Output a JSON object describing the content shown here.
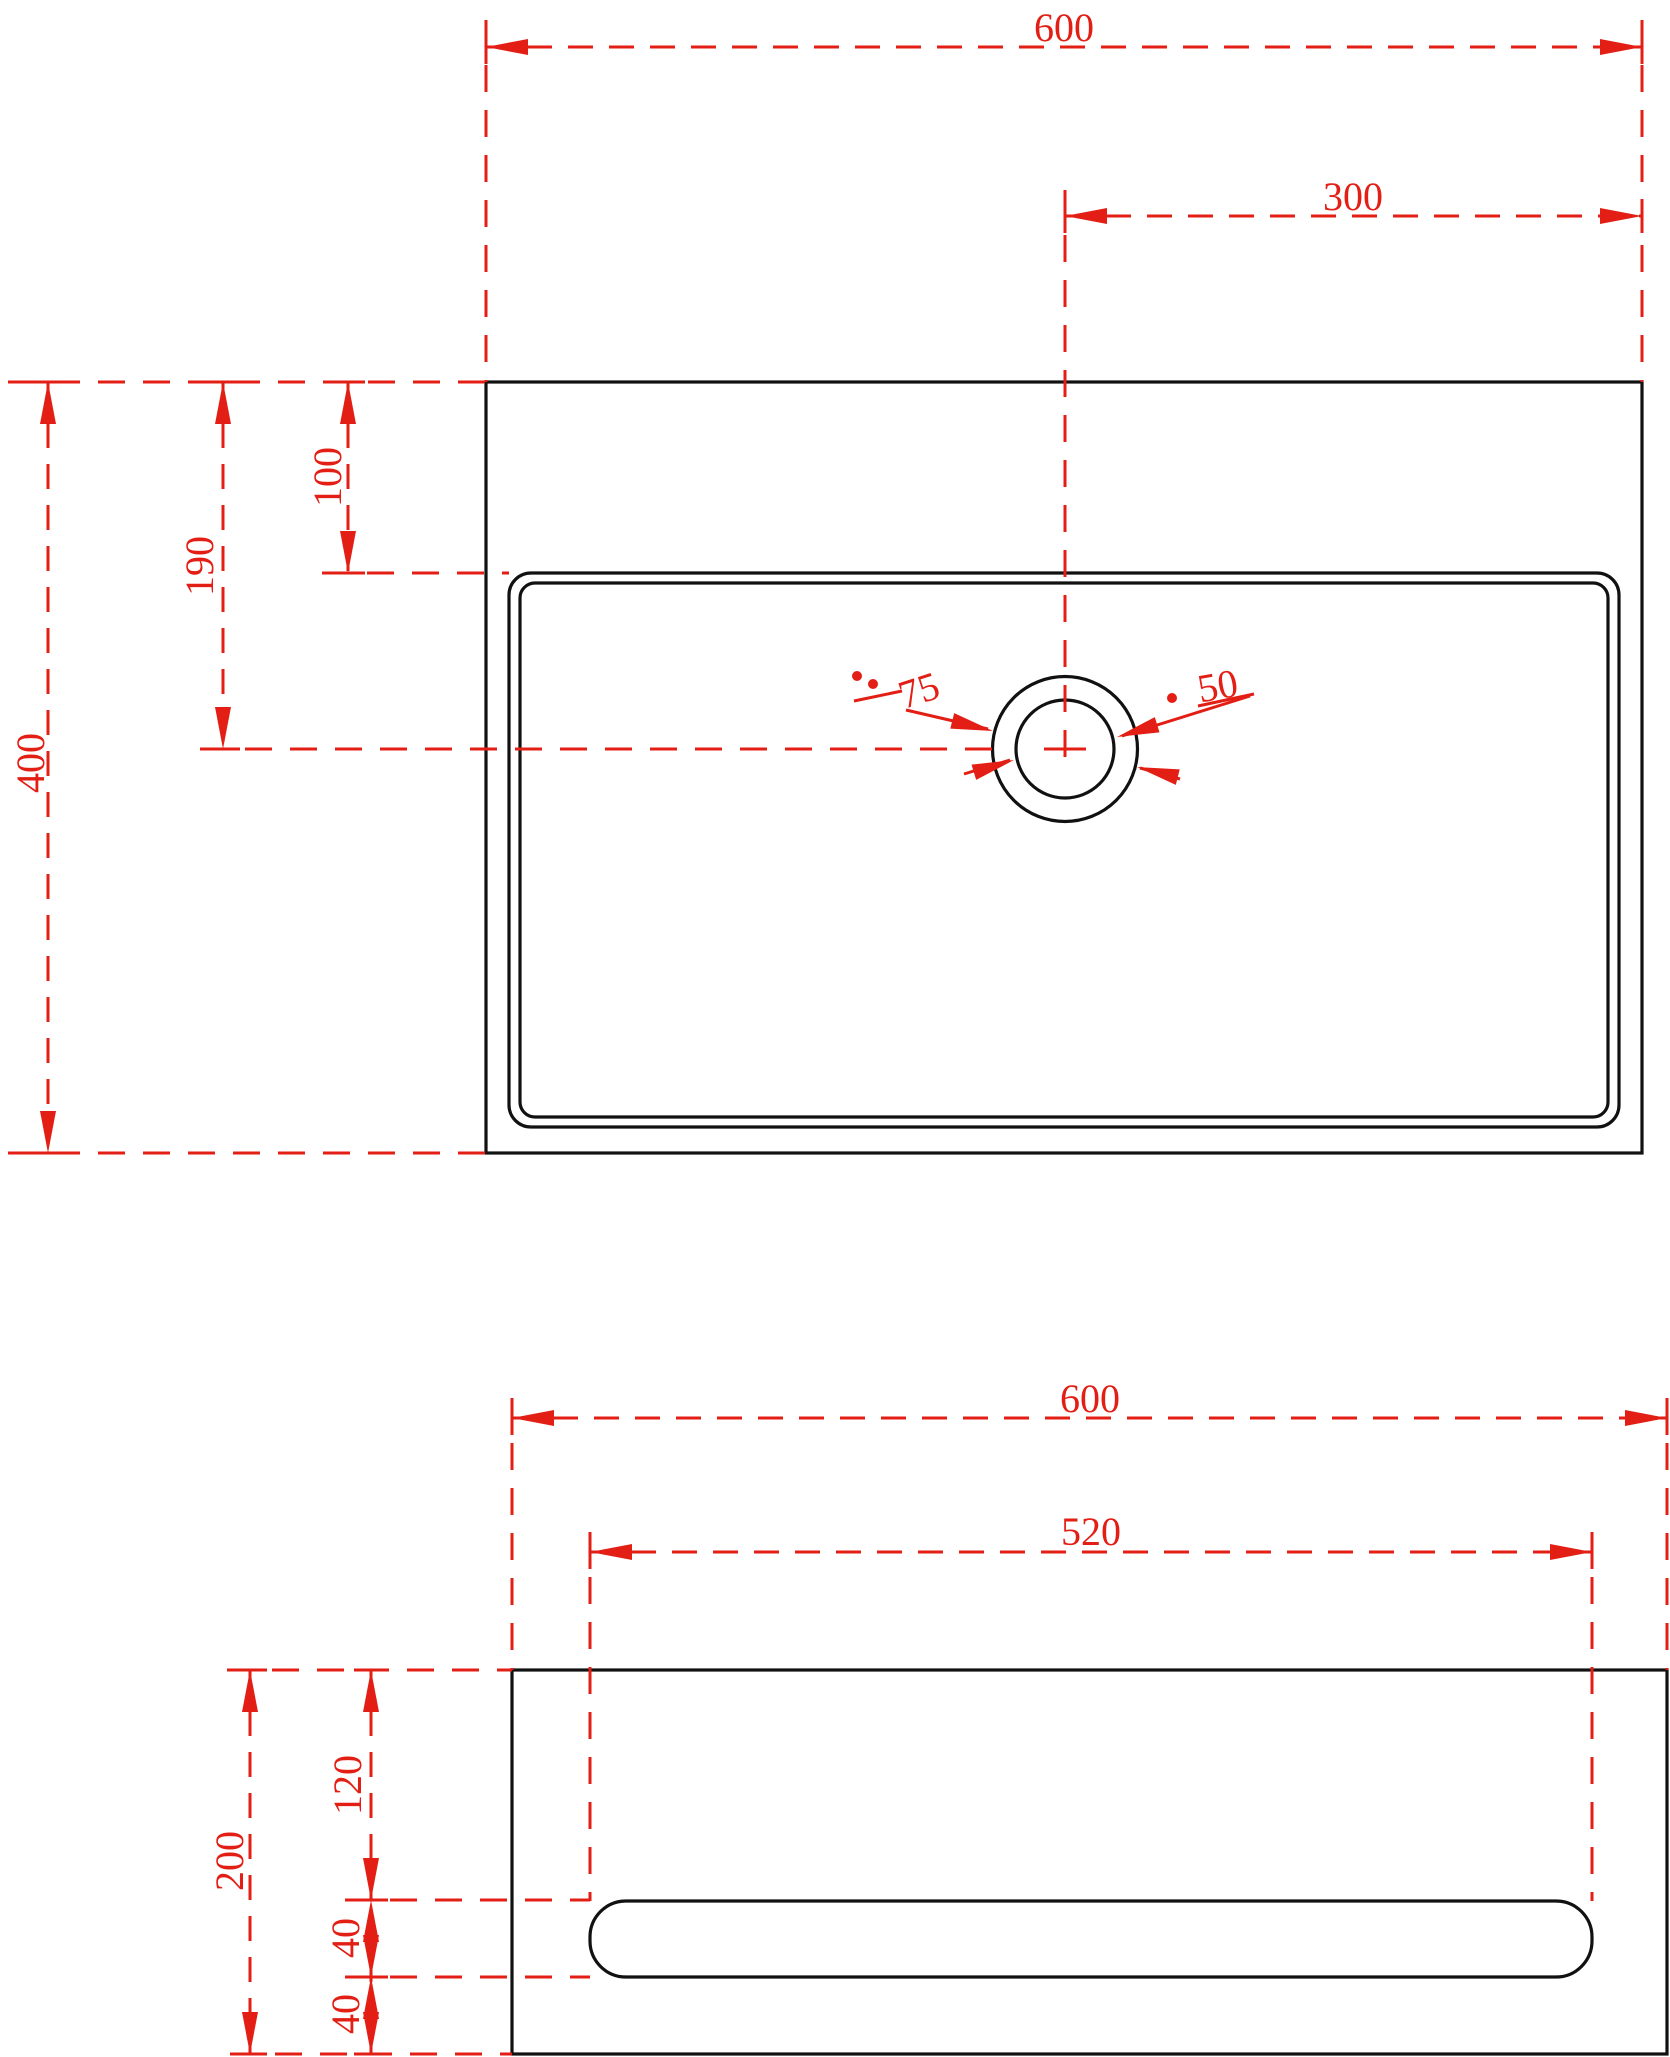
{
  "drawing": {
    "title": "Sink basin technical dimension drawing - top and front views",
    "units": "mm",
    "colors": {
      "dimension_red": "#e31e14",
      "line_black": "#111111",
      "background": "#ffffff"
    },
    "top_view": {
      "overall_width": "600",
      "drain_offset_from_right": "300",
      "overall_depth": "400",
      "drain_center_from_top": "190",
      "basin_rim_from_top": "100",
      "drain_outer_diameter": "75",
      "drain_inner_diameter": "50"
    },
    "front_view": {
      "overall_width": "600",
      "slot_width": "520",
      "overall_height": "200",
      "slot_from_top": "120",
      "slot_height": "40",
      "slot_from_bottom": "40"
    }
  }
}
